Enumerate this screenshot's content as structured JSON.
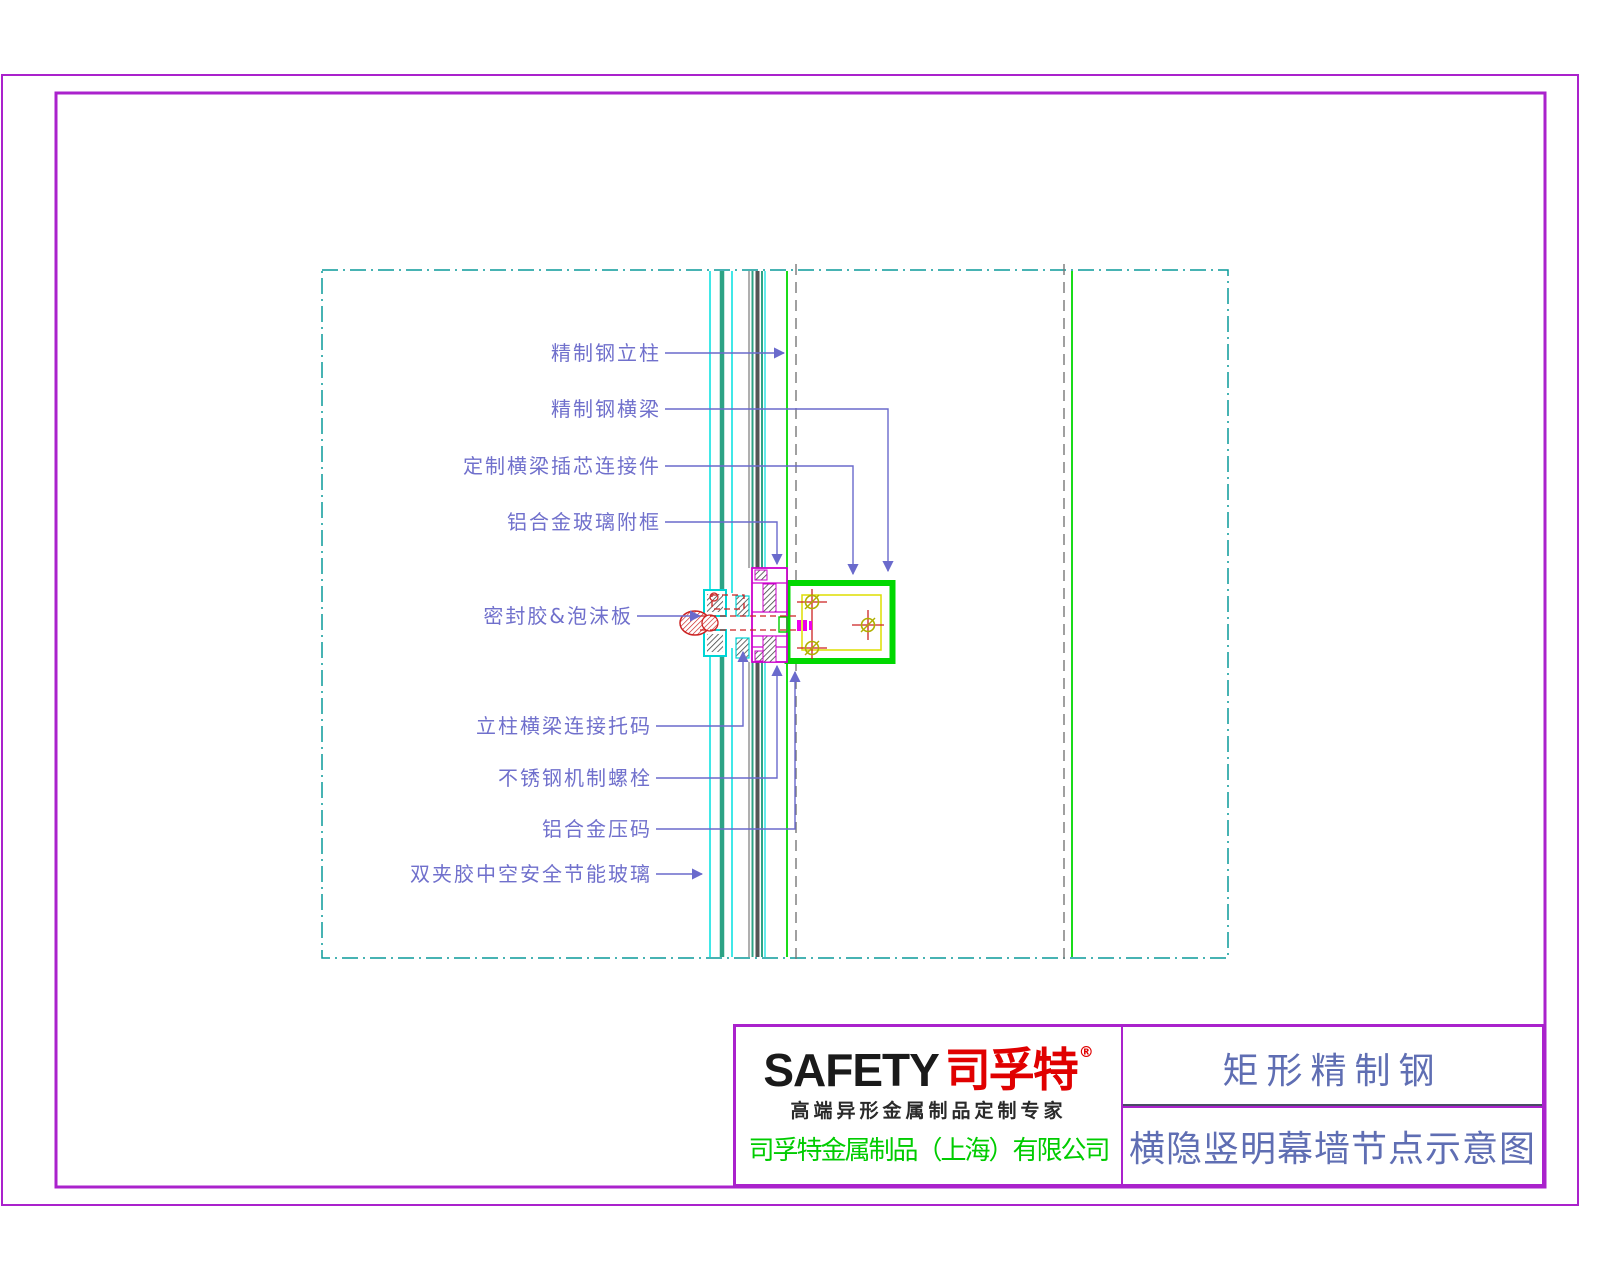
{
  "sheet": {
    "border_color": "#aa22cc",
    "viewport_border_color": "#0a9a9a",
    "background": "#ffffff"
  },
  "drawing": {
    "labels": [
      {
        "text": "精制钢立柱"
      },
      {
        "text": "精制钢横梁"
      },
      {
        "text": "定制横梁插芯连接件"
      },
      {
        "text": "铝合金玻璃附框"
      },
      {
        "text": "密封胶&泡沫板"
      },
      {
        "text": "立柱横梁连接托码"
      },
      {
        "text": "不锈钢机制螺栓"
      },
      {
        "text": "铝合金压码"
      },
      {
        "text": "双夹胶中空安全节能玻璃"
      }
    ],
    "colors": {
      "leader": "#6a6acc",
      "glass_edge_cyan": "#00e0e0",
      "glass_core_teal": "#2da385",
      "steel_green": "#00d800",
      "inner_frame_yellow": "#dede00",
      "profile_magenta": "#cc00cc",
      "sealant_red": "#cc2222",
      "centerline_gray": "#777777",
      "bolt_circle_olive": "#b0b000"
    }
  },
  "title_block": {
    "logo": {
      "brand_en": "SAFETY",
      "brand_cn": "司孚特",
      "registered_mark": "®",
      "tagline": "高端异形金属制品定制专家",
      "company": "司孚特金属制品（上海）有限公司"
    },
    "project": {
      "name": "矩形精制钢",
      "drawing_title": "横隐竖明幕墙节点示意图"
    }
  }
}
